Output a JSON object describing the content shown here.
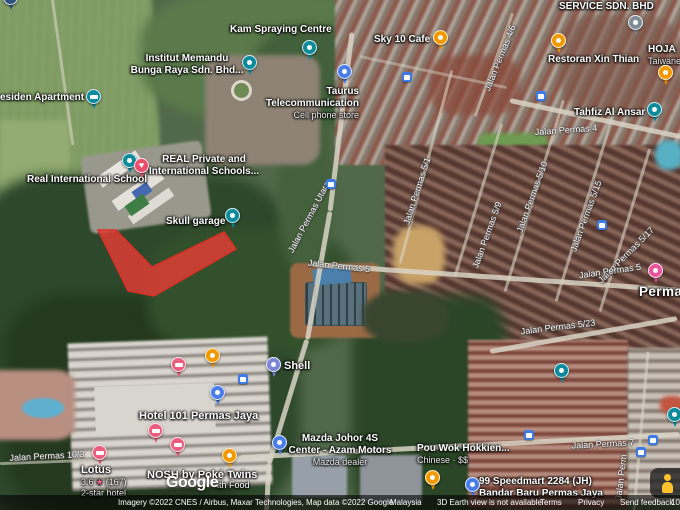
{
  "map_type": "satellite",
  "pois": {
    "kam_spraying": {
      "name": "Kam Spraying Centre"
    },
    "institut_memandu": {
      "line1": "Institut Memandu",
      "line2": "Bunga Raya Sdn. Bhd..."
    },
    "residen_apartment": {
      "name": "esiden Apartment"
    },
    "sky10_cafe": {
      "name": "Sky 10 Cafe"
    },
    "service_sdn_bhd": {
      "name": "SERVICE SDN. BHD"
    },
    "restoran_xin_thian": {
      "name": "Restoran Xin Thian"
    },
    "hoja": {
      "line1": "HOJA",
      "line2": "Taiwane"
    },
    "taurus": {
      "line1": "Taurus",
      "line2": "Telecommunication",
      "category": "Cell phone store"
    },
    "tahfiz_al_ansar": {
      "name": "Tahfiz Al Ansar"
    },
    "real_private": {
      "line1": "REAL Private and",
      "line2": "International Schools..."
    },
    "real_international_school": {
      "name": "Real International School"
    },
    "skull_garage": {
      "name": "Skull garage"
    },
    "hotel_101": {
      "name": "Hotel 101 Permas Jaya"
    },
    "shell": {
      "name": "Shell"
    },
    "mazda": {
      "line1": "Mazda Johor 4S",
      "line2": "Center - Azam Motors",
      "category": "Mazda dealer"
    },
    "pou_wok": {
      "name": "Pou Wok Hokkien...",
      "category": "Chinese · $$"
    },
    "speedmart": {
      "line1": "99 Speedmart 2284 (JH)",
      "line2": "Bandar Baru Permas Jaya"
    },
    "lotus": {
      "name": "Lotus",
      "rating": "3.6",
      "reviews": "(167)",
      "category": "2-star hotel"
    },
    "nosh": {
      "name": "NOSH by Poké Twins",
      "partial_line2": "lth Food"
    },
    "permas_locality": {
      "name": "Permas"
    }
  },
  "streets": [
    {
      "text": "Jalan Permas 4/6"
    },
    {
      "text": "Jalan Permas 4"
    },
    {
      "text": "Jalan Permas Utara"
    },
    {
      "text": "Jalan Permas 5"
    },
    {
      "text": "Jalan Permas 5/1"
    },
    {
      "text": "Jalan Permas 5/9"
    },
    {
      "text": "Jalan Permas 5/10"
    },
    {
      "text": "Jalan Permas 5/15"
    },
    {
      "text": "Jalan Permas 5/17"
    },
    {
      "text": "Jalan Permas 5"
    },
    {
      "text": "Jalan Permas 5/23"
    },
    {
      "text": "Jalan Permas 7"
    },
    {
      "text": "Jalan Perm"
    },
    {
      "text": "Jalan Permas 10/3"
    }
  ],
  "footer": {
    "logo": "Google",
    "imagery_credit": "Imagery ©2022 CNES / Airbus, Maxar Technologies, Map data ©2022 Google",
    "country": "Malaysia",
    "earth_view_notice": "3D Earth view is not available",
    "terms": "Terms",
    "privacy": "Privacy",
    "send_feedback": "Send feedback",
    "scale_partial": "10"
  },
  "overlay": {
    "shape": "polygon-highlight",
    "fill": "#ea3b34",
    "opacity": 0.8,
    "points": "98,230 116,230 152,267 224,232 236,249 154,296 128,291"
  },
  "colors": {
    "marker_teal": "#0d8a9c",
    "marker_orange": "#f29900",
    "marker_pink": "#ea5d7d",
    "marker_magenta": "#e9549b",
    "marker_blue": "#4a7de8",
    "marker_purple": "#7c85d6",
    "marker_gray": "#7f8d96",
    "marker_heart": "#e94f6c",
    "bus_blue": "#3d7ae5",
    "highlight_red": "#ea3b34"
  },
  "icons": [
    "place-icon",
    "lodging-icon",
    "restaurant-icon",
    "cafe-icon",
    "phone-store-icon",
    "gas-station-icon",
    "grocery-icon",
    "car-dealer-icon",
    "school-icon",
    "heart-icon",
    "shopping-icon",
    "bus-stop-icon",
    "garage-icon",
    "pegman-icon"
  ]
}
